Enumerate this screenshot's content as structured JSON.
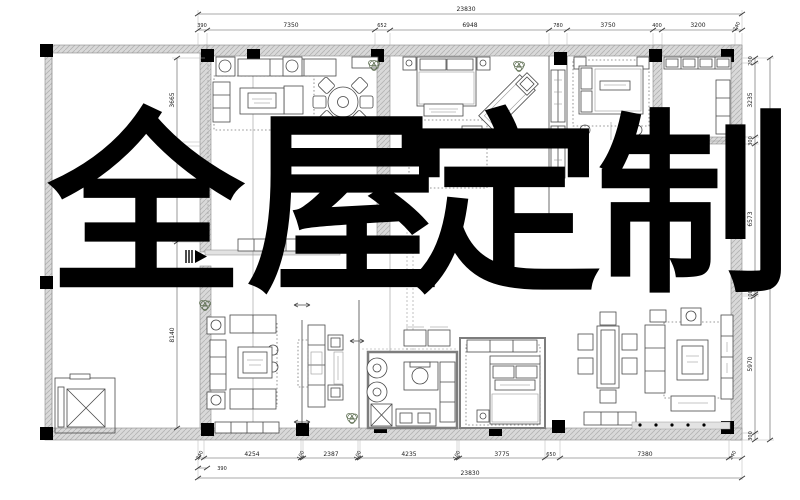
{
  "overlay": {
    "text": "全屋定制",
    "chars": [
      "全",
      "屋",
      "定",
      "制"
    ]
  },
  "dimensions": {
    "top": {
      "total": "23830",
      "segments": [
        "390",
        "7350",
        "652",
        "6948",
        "780",
        "3750",
        "400",
        "3200",
        "240"
      ]
    },
    "bottom": {
      "total": "23830",
      "sub": "390",
      "segments": [
        "240",
        "4254",
        "100",
        "2387",
        "100",
        "4235",
        "100",
        "3775",
        "650",
        "7380",
        "240"
      ]
    },
    "left": {
      "segments": [
        "3665",
        "150",
        "8140"
      ]
    },
    "right": {
      "total": "17160",
      "segments": [
        "200",
        "3235",
        "300",
        "6573",
        "100",
        "5970",
        "300"
      ]
    }
  },
  "colors": {
    "ink": "#000000",
    "wall": "#d9d9d9",
    "line": "#4a4a4a",
    "dim": "#555555"
  }
}
